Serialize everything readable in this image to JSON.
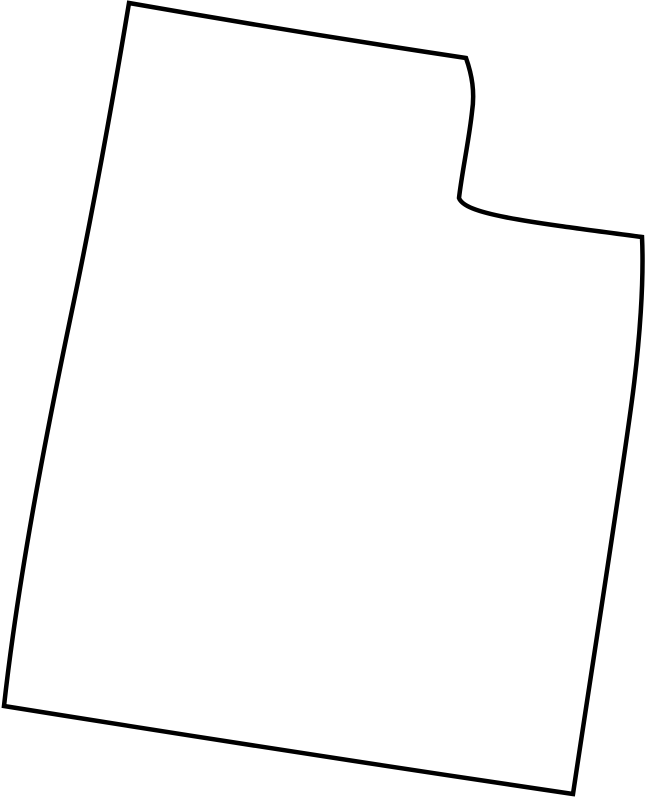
{
  "page": {
    "background_color": "#ffffff"
  },
  "map": {
    "region": "utah",
    "kind": "blank-state-outline",
    "canvas": {
      "width": 649,
      "height": 800
    },
    "outline": {
      "stroke_color": "#000000",
      "fill_color": "#ffffff",
      "stroke_width": 4.5,
      "path": "M 129 3 Q 300 33 466 58 C 472 75 475 92 472 112 C 469 140 462 172 459 198 C 465 214 520 221 642 237 C 644 280 640 340 632 400 C 620 490 590 680 573 794 Q 290 752 4 706 C 18 580 45 440 70 320 C 90 225 112 105 129 3 Z"
    }
  }
}
